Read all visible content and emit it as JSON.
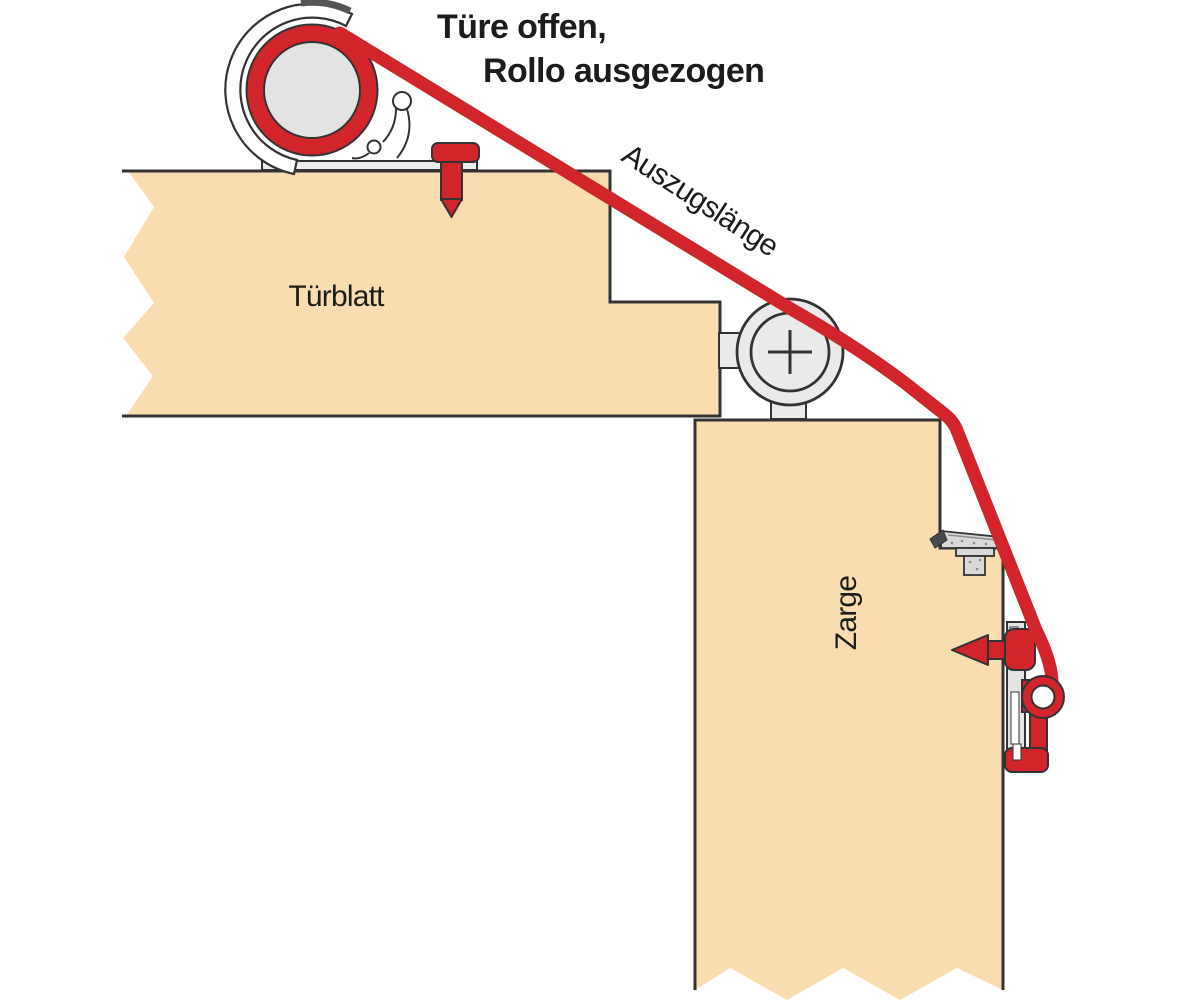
{
  "diagram": {
    "headline": {
      "line1": "Türe offen,",
      "line2": "Rollo ausgezogen"
    },
    "labels": {
      "extension_length": "Auszugslänge",
      "door_leaf": "Türblatt",
      "door_frame": "Zarge"
    },
    "colors": {
      "band_red": "#d2242b",
      "wood_beige": "#f9ddb0",
      "outline_dark": "#333333",
      "metal_light": "#ececec",
      "metal_mid": "#dcdcdc"
    },
    "parts": [
      "roller-housing",
      "roller-band-coil",
      "door-fastening-pin",
      "deflection-pulley",
      "strike-plate",
      "frame-fastening-pin",
      "band-end-bracket",
      "seal-band"
    ]
  }
}
